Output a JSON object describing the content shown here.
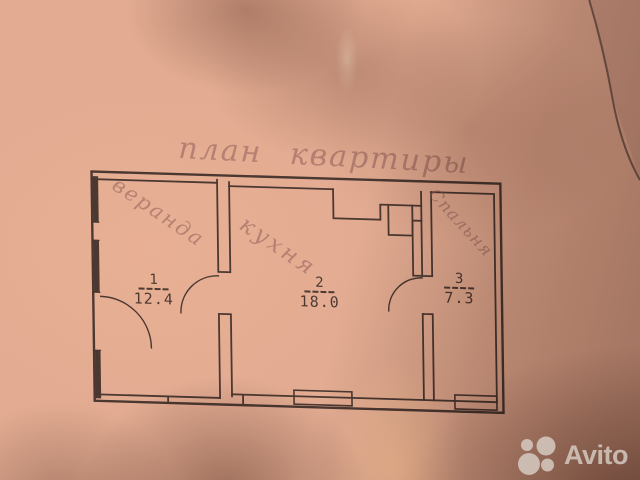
{
  "photo": {
    "description": "photograph of a hand-drawn apartment floor plan on pink-toned paper with diagonal shadow",
    "paper_color": "#e3ac92",
    "ink_color": "#4b3831",
    "pencil_color": "#a97f7a",
    "shadow_color": "#8f7265",
    "watermark_color": "#d8cec5"
  },
  "title": "план квартиры",
  "rooms": [
    {
      "name": "веранда",
      "number": "1",
      "area": "12.4"
    },
    {
      "name": "кухня",
      "number": "2",
      "area": "18.0"
    },
    {
      "name": "Спальня",
      "number": "3",
      "area": "7.3"
    }
  ],
  "watermark": {
    "brand": "Avito",
    "logo": "avito-circles-icon"
  }
}
